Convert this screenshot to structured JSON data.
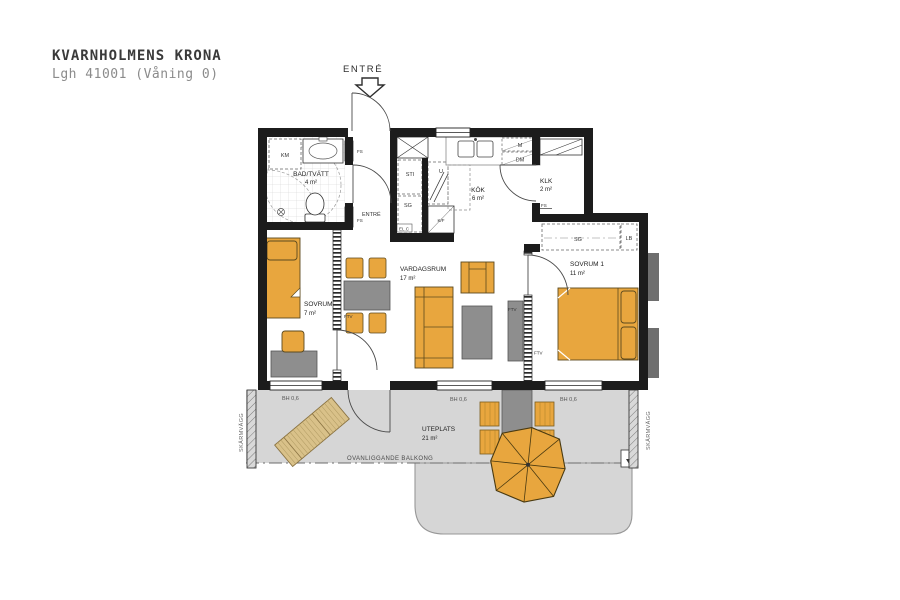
{
  "header": {
    "title": "KVARNHOLMENS KRONA",
    "subtitle": "Lgh 41001 (Våning 0)"
  },
  "entrance_label": "ENTRÉ",
  "rooms": {
    "bathroom": {
      "name": "BAD/TVÄTT",
      "area": "4 m²"
    },
    "hall": {
      "name": "ENTRÉ"
    },
    "kitchen": {
      "name": "KÖK",
      "area": "6 m²"
    },
    "klk": {
      "name": "KLK",
      "area": "2 m²"
    },
    "living": {
      "name": "VARDAGSRUM",
      "area": "17 m²"
    },
    "bedroom1": {
      "name": "SOVRUM 1",
      "area": "11 m²"
    },
    "bedroom2": {
      "name": "SOVRUM 2",
      "area": "7 m²"
    },
    "patio": {
      "name": "UTEPLATS",
      "area": "21 m²"
    }
  },
  "fixtures": {
    "km": "KM",
    "sti": "STI",
    "sg_hall": "SG",
    "u": "U",
    "kf": "K/F",
    "elc": "EL.C",
    "m": "M",
    "dm": "DM",
    "sg_bedroom": "SG",
    "lb": "LB",
    "fs_hall_top": "FS",
    "fs_hall_bottom": "FS",
    "fs_klk": "FS",
    "ftv_living_left": "FTV",
    "ftv_living_right": "FTV",
    "ftv_bedroom1": "FTV"
  },
  "annotations": {
    "balcony_above": "OVANLIGGANDE BALKONG",
    "screen_wall_left": "SKÄRMVÄGG",
    "screen_wall_right": "SKÄRMVÄGG",
    "sill_height_1": "BH 0,6",
    "sill_height_2": "BH 0,6",
    "sill_height_3": "BH 0,6"
  },
  "colors": {
    "accent_furniture": "#E8A63E",
    "gray_furniture": "#8E8E8E",
    "terrace_gray": "#D6D6D6",
    "wall_black": "#1C1C1C",
    "lounger_tan": "#D9C189"
  }
}
